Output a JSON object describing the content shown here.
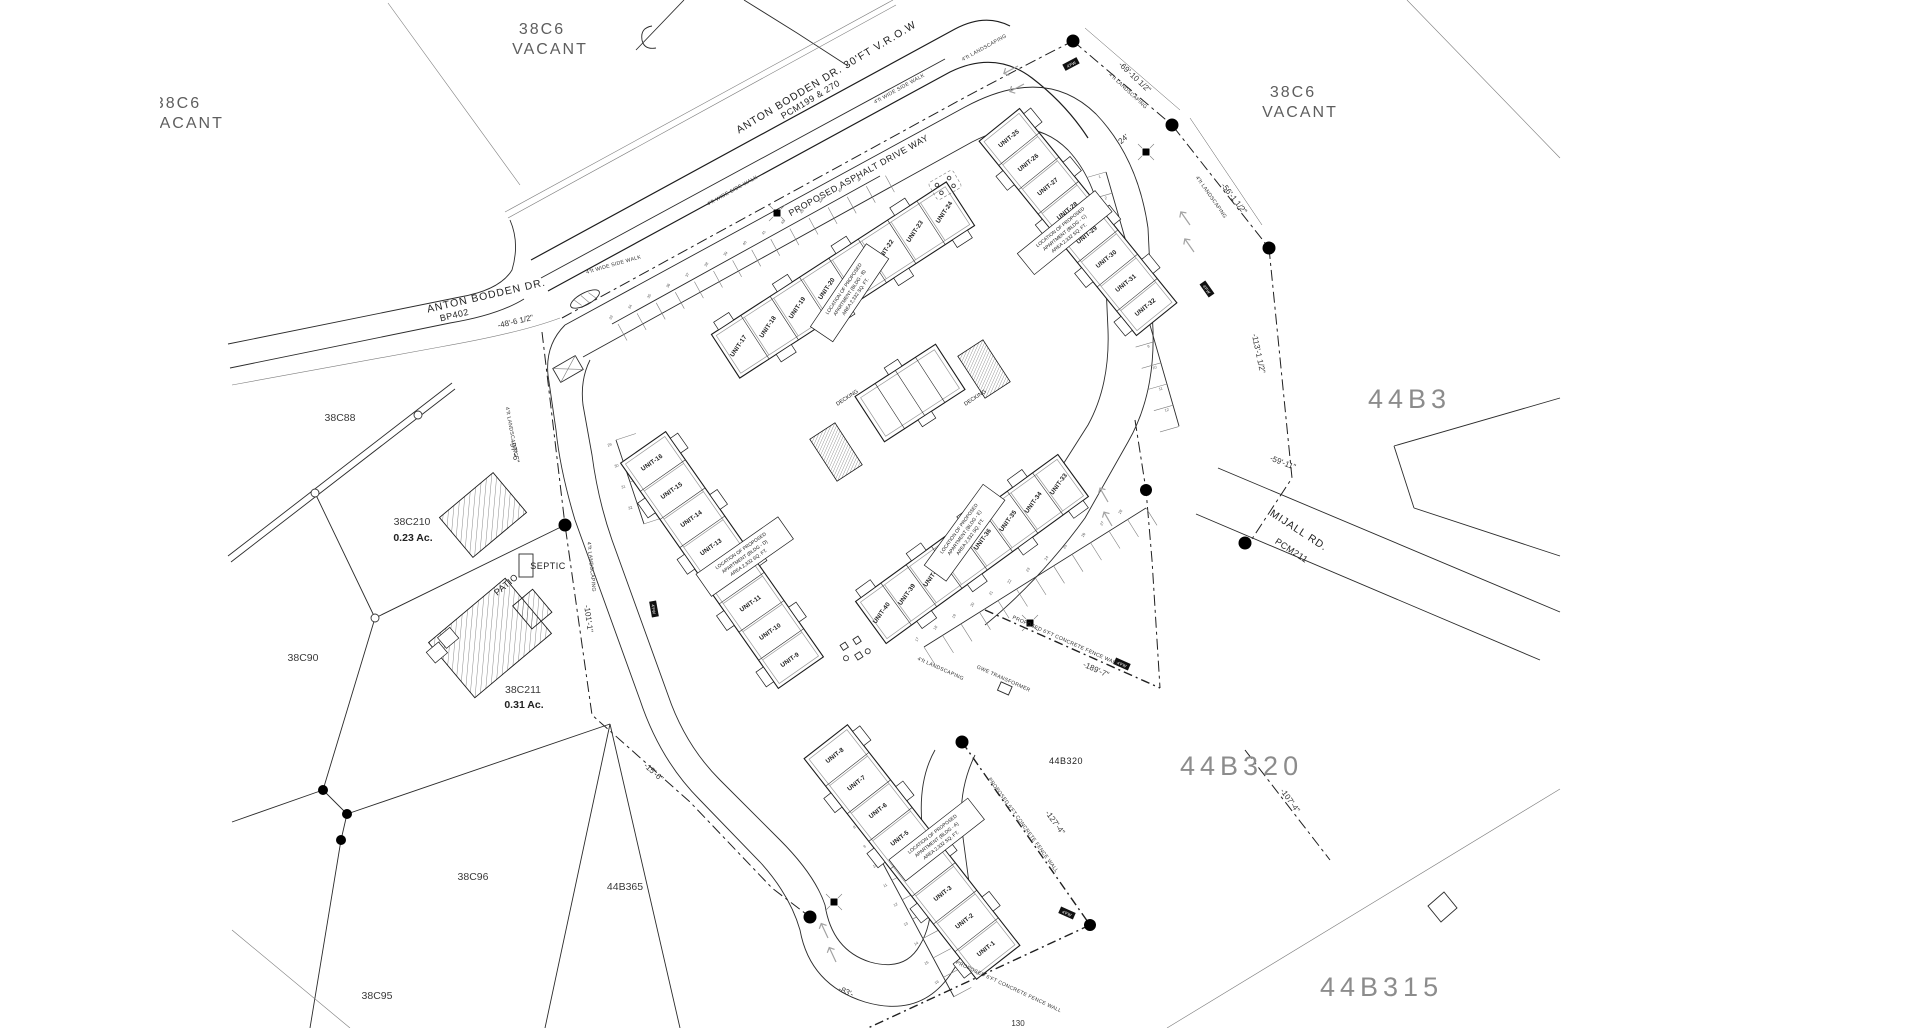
{
  "parcels": {
    "vacant_tl_id": "38C6",
    "vacant_tl_status": "VACANT",
    "vacant_tr_id": "38C6",
    "vacant_tr_status": "VACANT",
    "vacant_left_id": "38C6",
    "vacant_left_status": "VACANT",
    "c88": "38C88",
    "c210": "38C210",
    "c210_area": "0.23 Ac.",
    "c90": "38C90",
    "c211": "38C211",
    "c211_area": "0.31 Ac.",
    "c96": "38C96",
    "b365": "44B365",
    "c95": "38C95",
    "b3": "44B3",
    "b320_big": "44B320",
    "b320_small": "44B320",
    "b315": "44B315"
  },
  "roads": {
    "anton_row_1": "ANTON BODDEN DR. 30'FT V.R.O.W",
    "anton_row_2": "PCM199 & 270",
    "anton_1": "ANTON BODDEN DR.",
    "anton_2": "BP402",
    "mijall_1": "MIJALL RD.",
    "mijall_2": "PCM211",
    "driveway": "PROPOSED ASPHALT DRIVE WAY",
    "sidewalk": "4'ft WIDE SIDE WALK",
    "landscaping": "4'ft LANDSCAPING",
    "fence_wall": "PROPOSED 6'FT CONCRETE FENCE WALL",
    "fw_marker": "4'FW"
  },
  "site_features": {
    "septic": "SEPTIC",
    "patio": "PATIO",
    "decking": "DECKING",
    "transformer": "GWE TRANSFORMER"
  },
  "dimensions": {
    "d69": "-69'-10 1/2\"",
    "d56": "-56'-1 1/2\"",
    "d113": "-113'-1 1/2\"",
    "d59": "-59'-11\"",
    "d48": "-48'-6 1/2\"",
    "d97": "-97'-6\"",
    "d101": "-101'-1\"",
    "d15": "-15'-6\"",
    "d189": "-189'-7\"",
    "d127": "-127'-4\"",
    "d107": "-107'-4\"",
    "d83": "-83'-",
    "d24": "24'",
    "d130": "130"
  },
  "buildings": [
    {
      "id": "bldg-b",
      "units": [
        "UNIT-17",
        "UNIT-18",
        "UNIT-19",
        "UNIT-20",
        "UNIT-21",
        "UNIT-22",
        "UNIT-23",
        "UNIT-24"
      ],
      "note": [
        "LOCATION OF PROPOSED",
        "APARTMENT (BLDG - B)",
        "AREA 2,332 SQ. FT."
      ]
    },
    {
      "id": "bldg-c",
      "units": [
        "UNIT-25",
        "UNIT-26",
        "UNIT-27",
        "UNIT-28",
        "UNIT-29",
        "UNIT-30",
        "UNIT-31",
        "UNIT-32"
      ],
      "note": [
        "LOCATION OF PROPOSED",
        "APARTMENT (BLDG - C)",
        "AREA 2,332 SQ. FT."
      ]
    },
    {
      "id": "bldg-d",
      "units": [
        "UNIT-16",
        "UNIT-15",
        "UNIT-14",
        "UNIT-13",
        "UNIT-12",
        "UNIT-11",
        "UNIT-10",
        "UNIT-9"
      ],
      "note": [
        "LOCATION OF PROPOSED",
        "APARTMENT (BLDG - D)",
        "AREA 2,332 SQ. FT."
      ]
    },
    {
      "id": "bldg-e",
      "units": [
        "UNIT-40",
        "UNIT-39",
        "UNIT-38",
        "UNIT-37",
        "UNIT-36",
        "UNIT-35",
        "UNIT-34",
        "UNIT-33"
      ],
      "note": [
        "LOCATION OF PROPOSED",
        "APARTMENT (BLDG - E)",
        "AREA 2,332 SQ. FT."
      ]
    },
    {
      "id": "bldg-a",
      "units": [
        "UNIT-8",
        "UNIT-7",
        "UNIT-6",
        "UNIT-5",
        "UNIT-4",
        "UNIT-3",
        "UNIT-2",
        "UNIT-1"
      ],
      "note": [
        "LOCATION OF PROPOSED",
        "APARTMENT (BLDG - A)",
        "AREA 2,332 SQ. FT."
      ]
    }
  ],
  "parking": {
    "row1": [
      "33",
      "34",
      "35",
      "36",
      "37",
      "38",
      "39",
      "40",
      "41",
      "42",
      "43",
      "44",
      "45",
      "46"
    ],
    "row2": [
      "1",
      "2",
      "3",
      "4",
      "5",
      "6",
      "7",
      "8",
      "9",
      "10",
      "11",
      "12"
    ],
    "row3": [
      "17",
      "18",
      "19",
      "20",
      "21",
      "22",
      "23",
      "24",
      "25",
      "26",
      "27",
      "28"
    ],
    "row4": [
      "5",
      "6",
      "7",
      "8",
      "9",
      "10",
      "11",
      "12",
      "13",
      "14",
      "15",
      "16"
    ],
    "row5": [
      "29",
      "30",
      "31",
      "32"
    ]
  }
}
